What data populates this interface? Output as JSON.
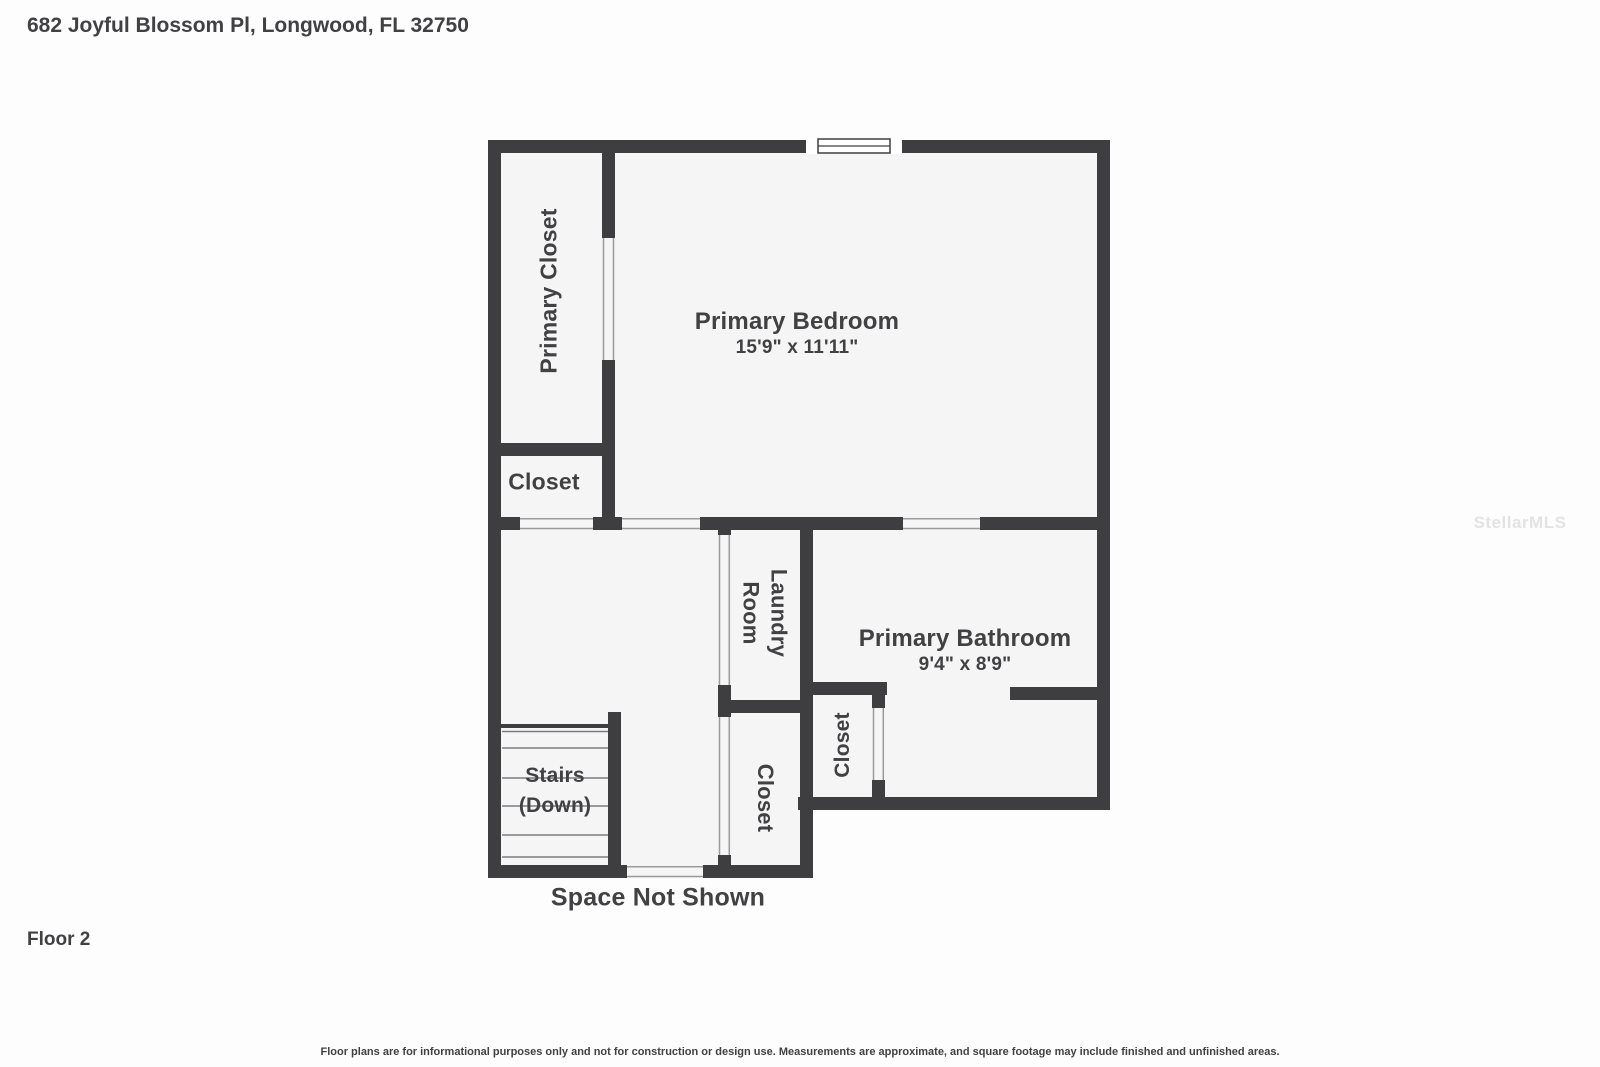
{
  "header": {
    "title": "682 Joyful Blossom Pl, Longwood, FL 32750"
  },
  "footer": {
    "floor_label": "Floor 2",
    "disclaimer": "Floor plans are for informational purposes only and not for construction or design use. Measurements are approximate, and square footage may include finished and unfinished areas."
  },
  "watermark": "StellarMLS",
  "plan": {
    "space_note": "Space Not Shown",
    "rooms": {
      "primary_bedroom": {
        "name": "Primary Bedroom",
        "dims": "15'9\" x 11'11\""
      },
      "primary_bathroom": {
        "name": "Primary Bathroom",
        "dims": "9'4\" x 8'9\""
      },
      "primary_closet": {
        "name": "Primary Closet"
      },
      "closet_top": {
        "name": "Closet"
      },
      "laundry": {
        "name": "Laundry Room"
      },
      "closet_mid": {
        "name": "Closet"
      },
      "closet_bath": {
        "name": "Closet"
      },
      "stairs": {
        "name": "Stairs (Down)"
      }
    },
    "colors": {
      "wall": "#3e3e40",
      "room_fill": "#f5f5f5",
      "label_text": "#414144",
      "door_jamb": "#9a9a9a",
      "watermark": "#e3e3e5"
    }
  }
}
